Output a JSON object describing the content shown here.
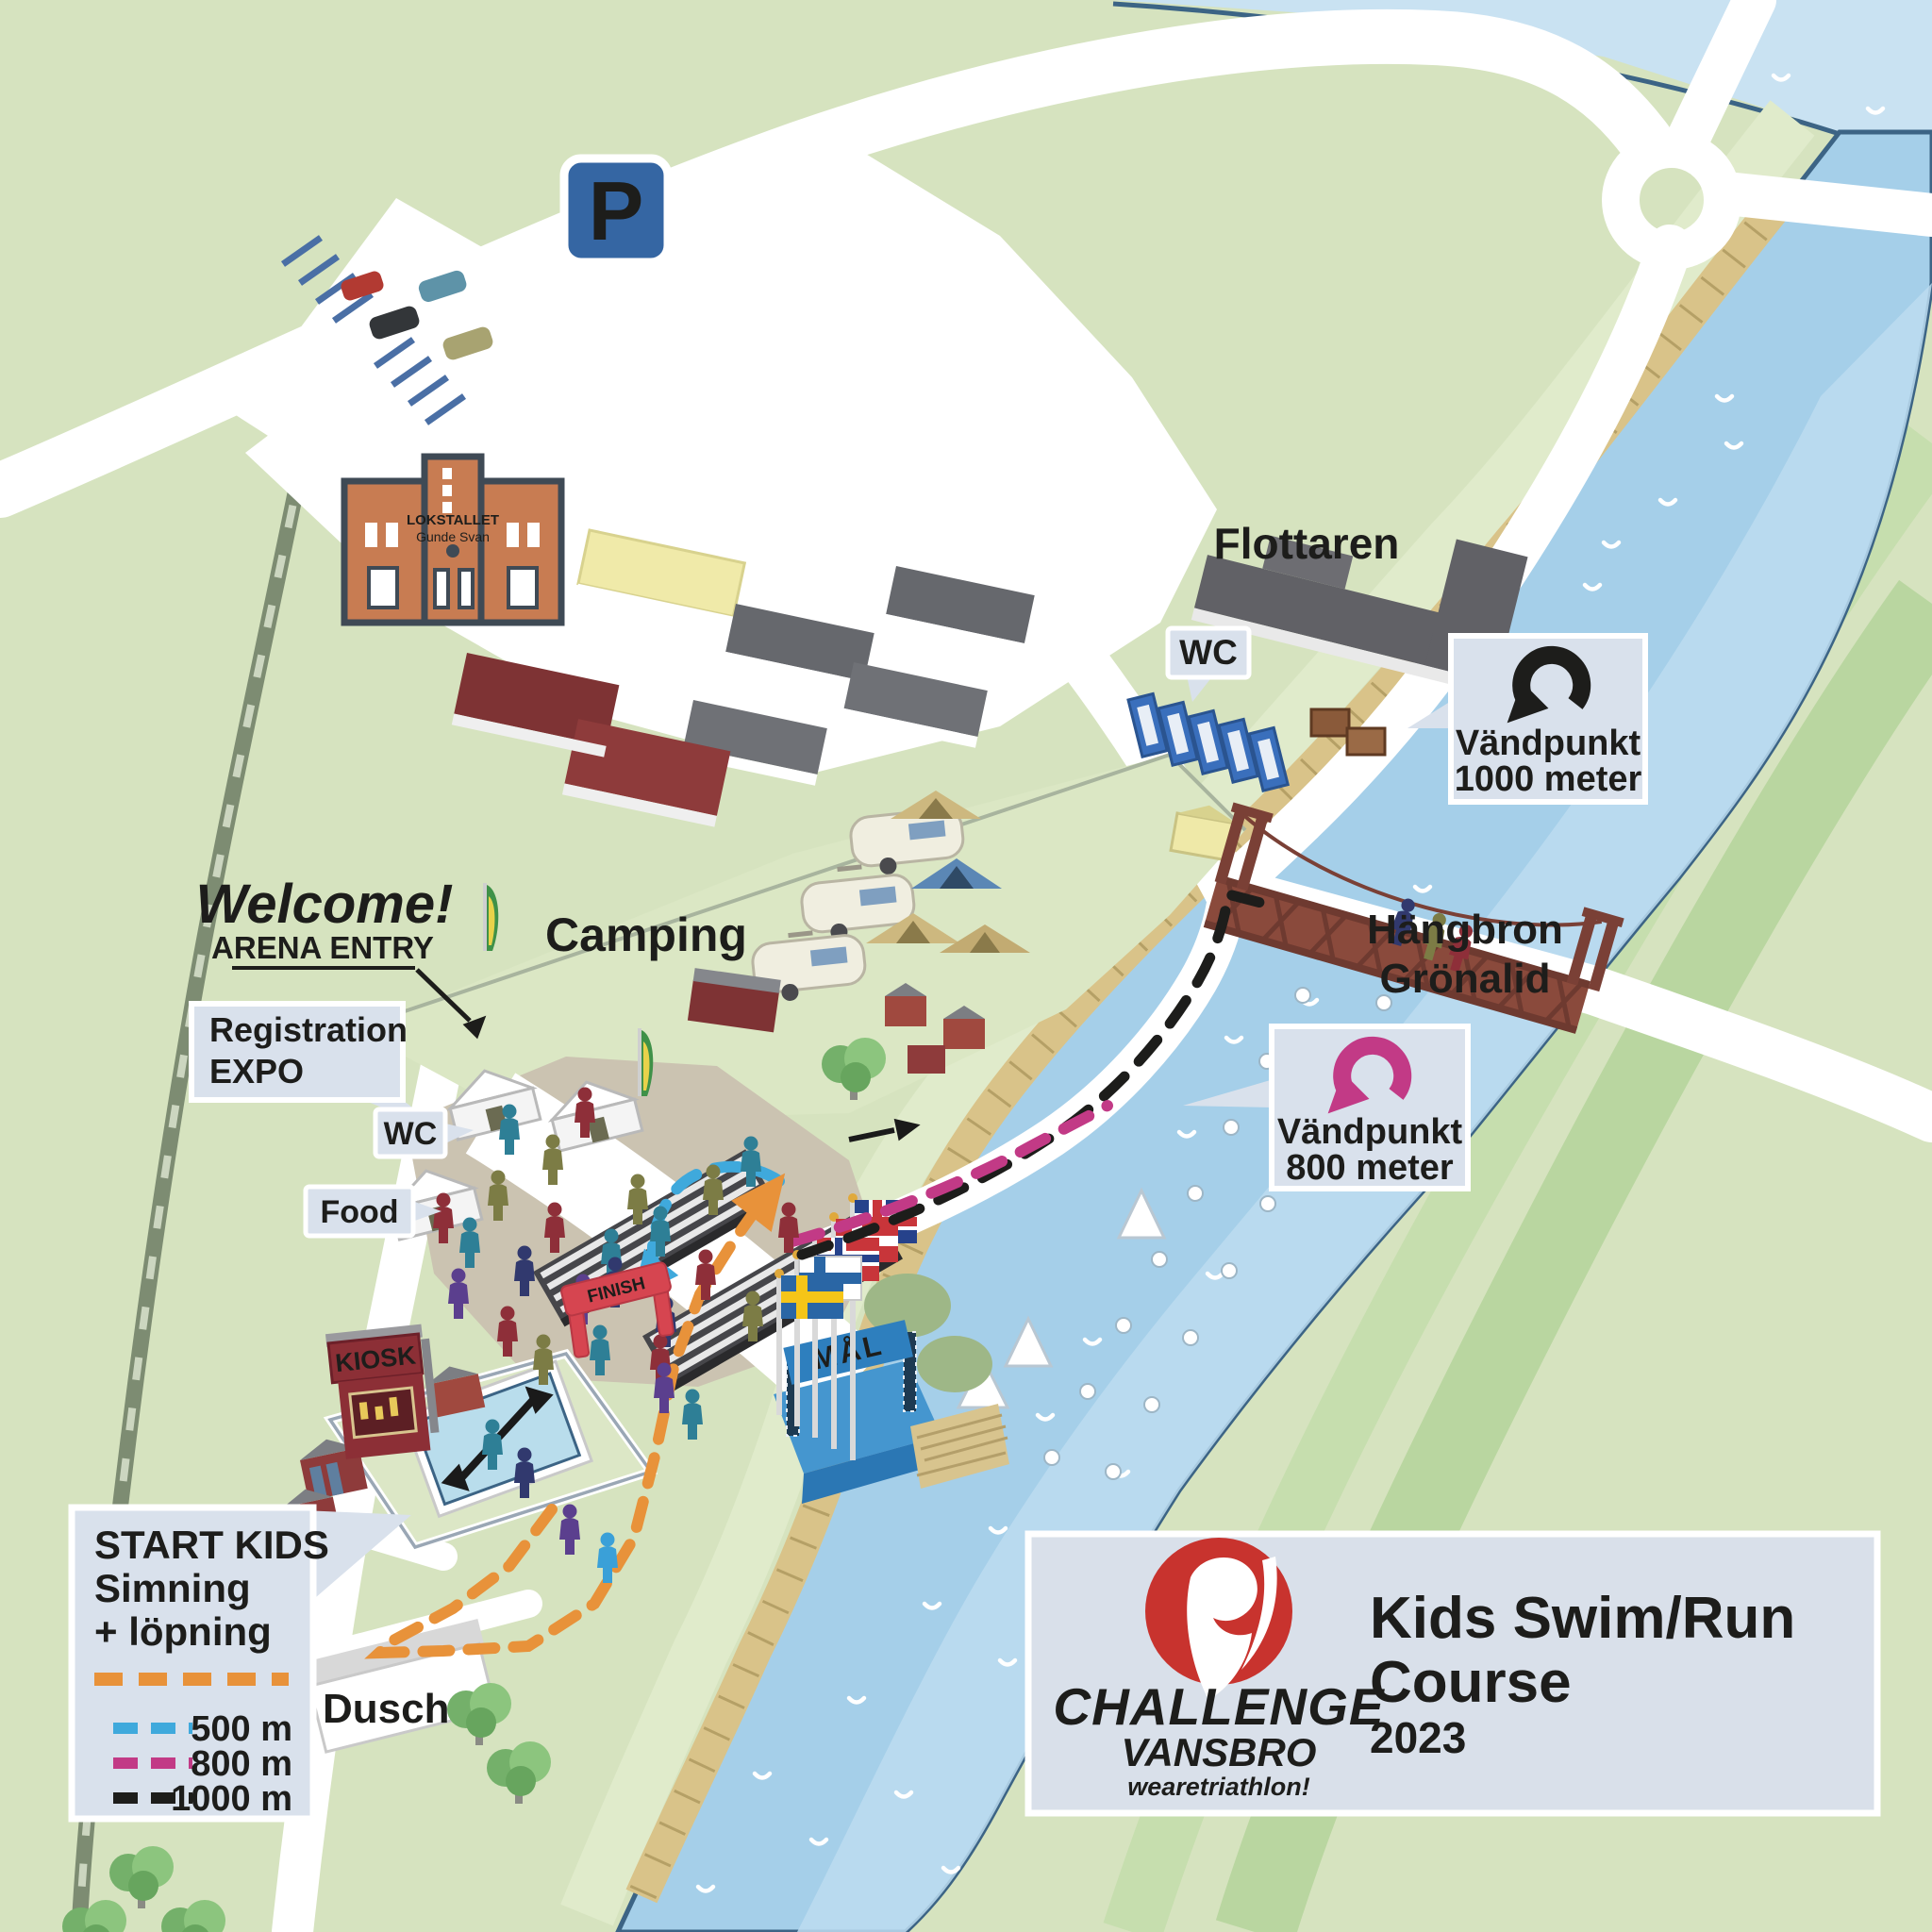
{
  "map": {
    "title": {
      "line1": "Kids Swim/Run",
      "line2": "Course",
      "year": "2023"
    },
    "logo": {
      "brand": "CHALLENGE",
      "city": "VANSBRO",
      "tagline": "wearetriathlon!",
      "color": "#c8332e"
    },
    "parking": {
      "label": "P"
    },
    "labels": {
      "flottaren": "Flottaren",
      "camping": "Camping",
      "welcome": "Welcome!",
      "arena_entry": "ARENA ENTRY",
      "dusch": "Dusch",
      "kiosk": "KIOSK",
      "finish": "FINISH",
      "mal": "MÅL",
      "wc_top": "WC",
      "wc_arena": "WC",
      "food": "Food",
      "bridge_line1": "Hängbron",
      "bridge_line2": "Grönalid",
      "building_line1": "LOKSTALLET",
      "building_line2": "Gunde Svan"
    },
    "callouts": {
      "registration": {
        "line1": "Registration",
        "line2": "EXPO"
      },
      "turn_1000": {
        "line1": "Vändpunkt",
        "line2": "1000 meter",
        "arrow_color": "#1d1d1b"
      },
      "turn_800": {
        "line1": "Vändpunkt",
        "line2": "800 meter",
        "arrow_color": "#c23a86"
      }
    },
    "start_box": {
      "line1": "START KIDS",
      "line2": "Simning",
      "line3": "+ löpning",
      "start_course_color": "#e8923a",
      "legend": [
        {
          "label": "500 m",
          "color": "#3fa9dc"
        },
        {
          "label": "800 m",
          "color": "#c23a86"
        },
        {
          "label": "1000 m",
          "color": "#1d1d1b"
        }
      ]
    },
    "courses": {
      "kids_run": {
        "color": "#e8923a"
      },
      "c500": {
        "color": "#3fa9dc"
      },
      "c800": {
        "color": "#c23a86"
      },
      "c1000": {
        "color": "#1d1d1b"
      }
    }
  }
}
